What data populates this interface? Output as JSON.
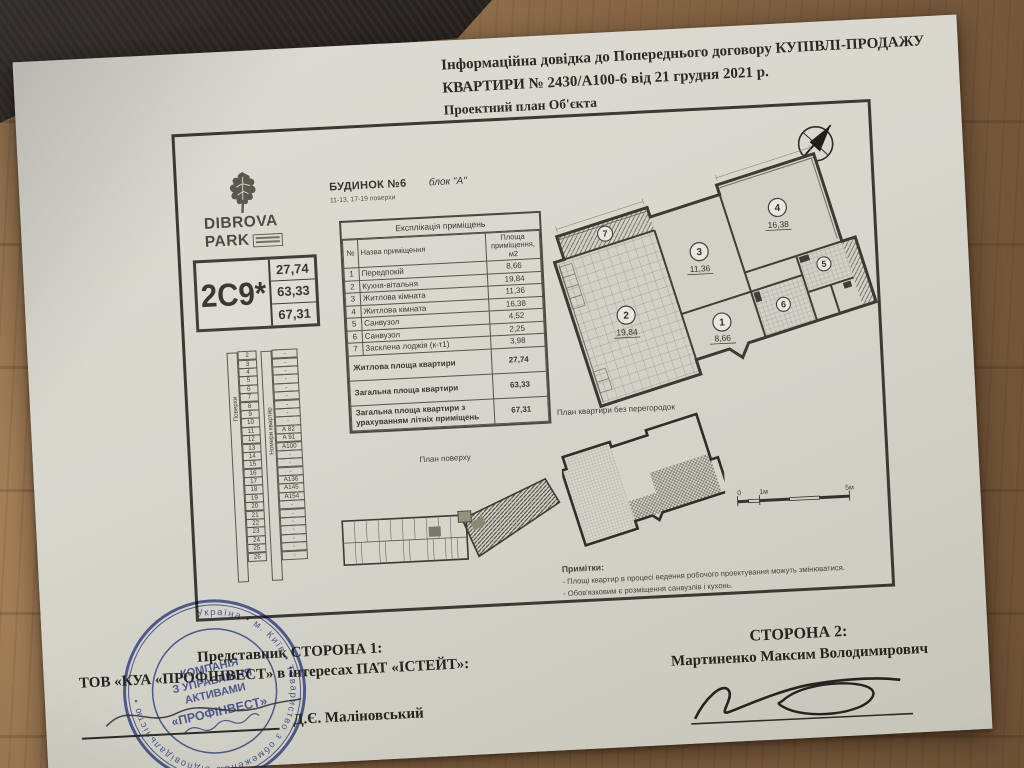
{
  "doc": {
    "header_line1": "Інформаційна довідка до Попереднього договору КУПІВЛІ-ПРОДАЖУ",
    "header_line2": "КВАРТИРИ № 2430/А100-6 від 21 грудня 2021 р.",
    "plan_title": "Проектний план Об'єкта"
  },
  "logo": {
    "name1": "DIBROVA",
    "name2": "PARK"
  },
  "building": {
    "title": "БУДИНОК №6",
    "block": "блок \"А\"",
    "floors": "11-13, 17-19 поверхи"
  },
  "apartment_code": {
    "code": "2С9*",
    "areas": [
      "27,74",
      "63,33",
      "67,31"
    ]
  },
  "explication": {
    "title": "Експлікація приміщень",
    "col_num": "№",
    "col_name": "Назва приміщення",
    "col_area": "Площа приміщення, м2",
    "rows": [
      {
        "num": "1",
        "name": "Передпокій",
        "area": "8,66"
      },
      {
        "num": "2",
        "name": "Кухня-вітальня",
        "area": "19,84"
      },
      {
        "num": "3",
        "name": "Житлова кімната",
        "area": "11,36"
      },
      {
        "num": "4",
        "name": "Житлова кімната",
        "area": "16,38"
      },
      {
        "num": "5",
        "name": "Санвузол",
        "area": "4,52"
      },
      {
        "num": "6",
        "name": "Санвузол",
        "area": "2,25"
      },
      {
        "num": "7",
        "name": "Засклена лоджія (к-т1)",
        "area": "3,98"
      }
    ],
    "totals": [
      {
        "label": "Житлова площа квартири",
        "value": "27,74"
      },
      {
        "label": "Загальна площа квартири",
        "value": "63,33"
      },
      {
        "label": "Загальна площа квартири з урахуванням літніх приміщень",
        "value": "67,31"
      }
    ]
  },
  "floors_table": {
    "floors_label": "Поверхи",
    "apts_label": "Номери квартир",
    "rows": [
      {
        "floor": "2",
        "apt": "-"
      },
      {
        "floor": "3",
        "apt": "-"
      },
      {
        "floor": "4",
        "apt": "-"
      },
      {
        "floor": "5",
        "apt": "-"
      },
      {
        "floor": "6",
        "apt": "-"
      },
      {
        "floor": "7",
        "apt": "-"
      },
      {
        "floor": "8",
        "apt": "-"
      },
      {
        "floor": "9",
        "apt": "-"
      },
      {
        "floor": "10",
        "apt": "-"
      },
      {
        "floor": "11",
        "apt": "А 82"
      },
      {
        "floor": "12",
        "apt": "А 91"
      },
      {
        "floor": "13",
        "apt": "А100"
      },
      {
        "floor": "14",
        "apt": "-"
      },
      {
        "floor": "15",
        "apt": "-"
      },
      {
        "floor": "16",
        "apt": "-"
      },
      {
        "floor": "17",
        "apt": "А136"
      },
      {
        "floor": "18",
        "apt": "А145"
      },
      {
        "floor": "19",
        "apt": "А154"
      },
      {
        "floor": "20",
        "apt": "-"
      },
      {
        "floor": "21",
        "apt": "-"
      },
      {
        "floor": "22",
        "apt": "-"
      },
      {
        "floor": "23",
        "apt": "-"
      },
      {
        "floor": "24",
        "apt": "-"
      },
      {
        "floor": "25",
        "apt": "-"
      },
      {
        "floor": "26",
        "apt": "-"
      }
    ]
  },
  "plan": {
    "compass_label": "N",
    "floor_plan_label": "План поверху",
    "no_partitions_label": "План квартири без перегородок",
    "rooms": [
      {
        "num": "1",
        "area": "8,66"
      },
      {
        "num": "2",
        "area": "19,84"
      },
      {
        "num": "3",
        "area": "11,36"
      },
      {
        "num": "4",
        "area": "16,38"
      },
      {
        "num": "5",
        "area": ""
      },
      {
        "num": "6",
        "area": ""
      },
      {
        "num": "7",
        "area": ""
      }
    ],
    "scale": {
      "zero": "0",
      "one": "1м",
      "five": "5м"
    }
  },
  "notes": {
    "title": "Примітки:",
    "items": [
      "- Площі квартир в процесі ведення робочого проектування можуть змінюватися.",
      "- Обов'язковим є розміщення санвузлів і кухонь."
    ]
  },
  "signing": {
    "party1_title": "Представник СТОРОНА 1:",
    "party1_line": "ТОВ «КУА «ПРОФІНВЕСТ» в інтересах ПАТ «ІСТЕЙТ»:",
    "party1_signer": "Д.Є. Маліновський",
    "party2_title": "СТОРОНА 2:",
    "party2_name": "Мартиненко Максим Володимирович",
    "stamp_center": [
      "КОМПАНІЯ",
      "З УПРАВЛІННЯ",
      "АКТИВАМИ",
      "«ПРОФІНВЕСТ»"
    ],
    "stamp_ring": "Україна • м. Київ • Товариство з обмеженою відповідальністю •"
  },
  "colors": {
    "stamp_blue": "#3c4aa0",
    "ink": "#2c2b26",
    "paper": "#d7d6cd"
  }
}
